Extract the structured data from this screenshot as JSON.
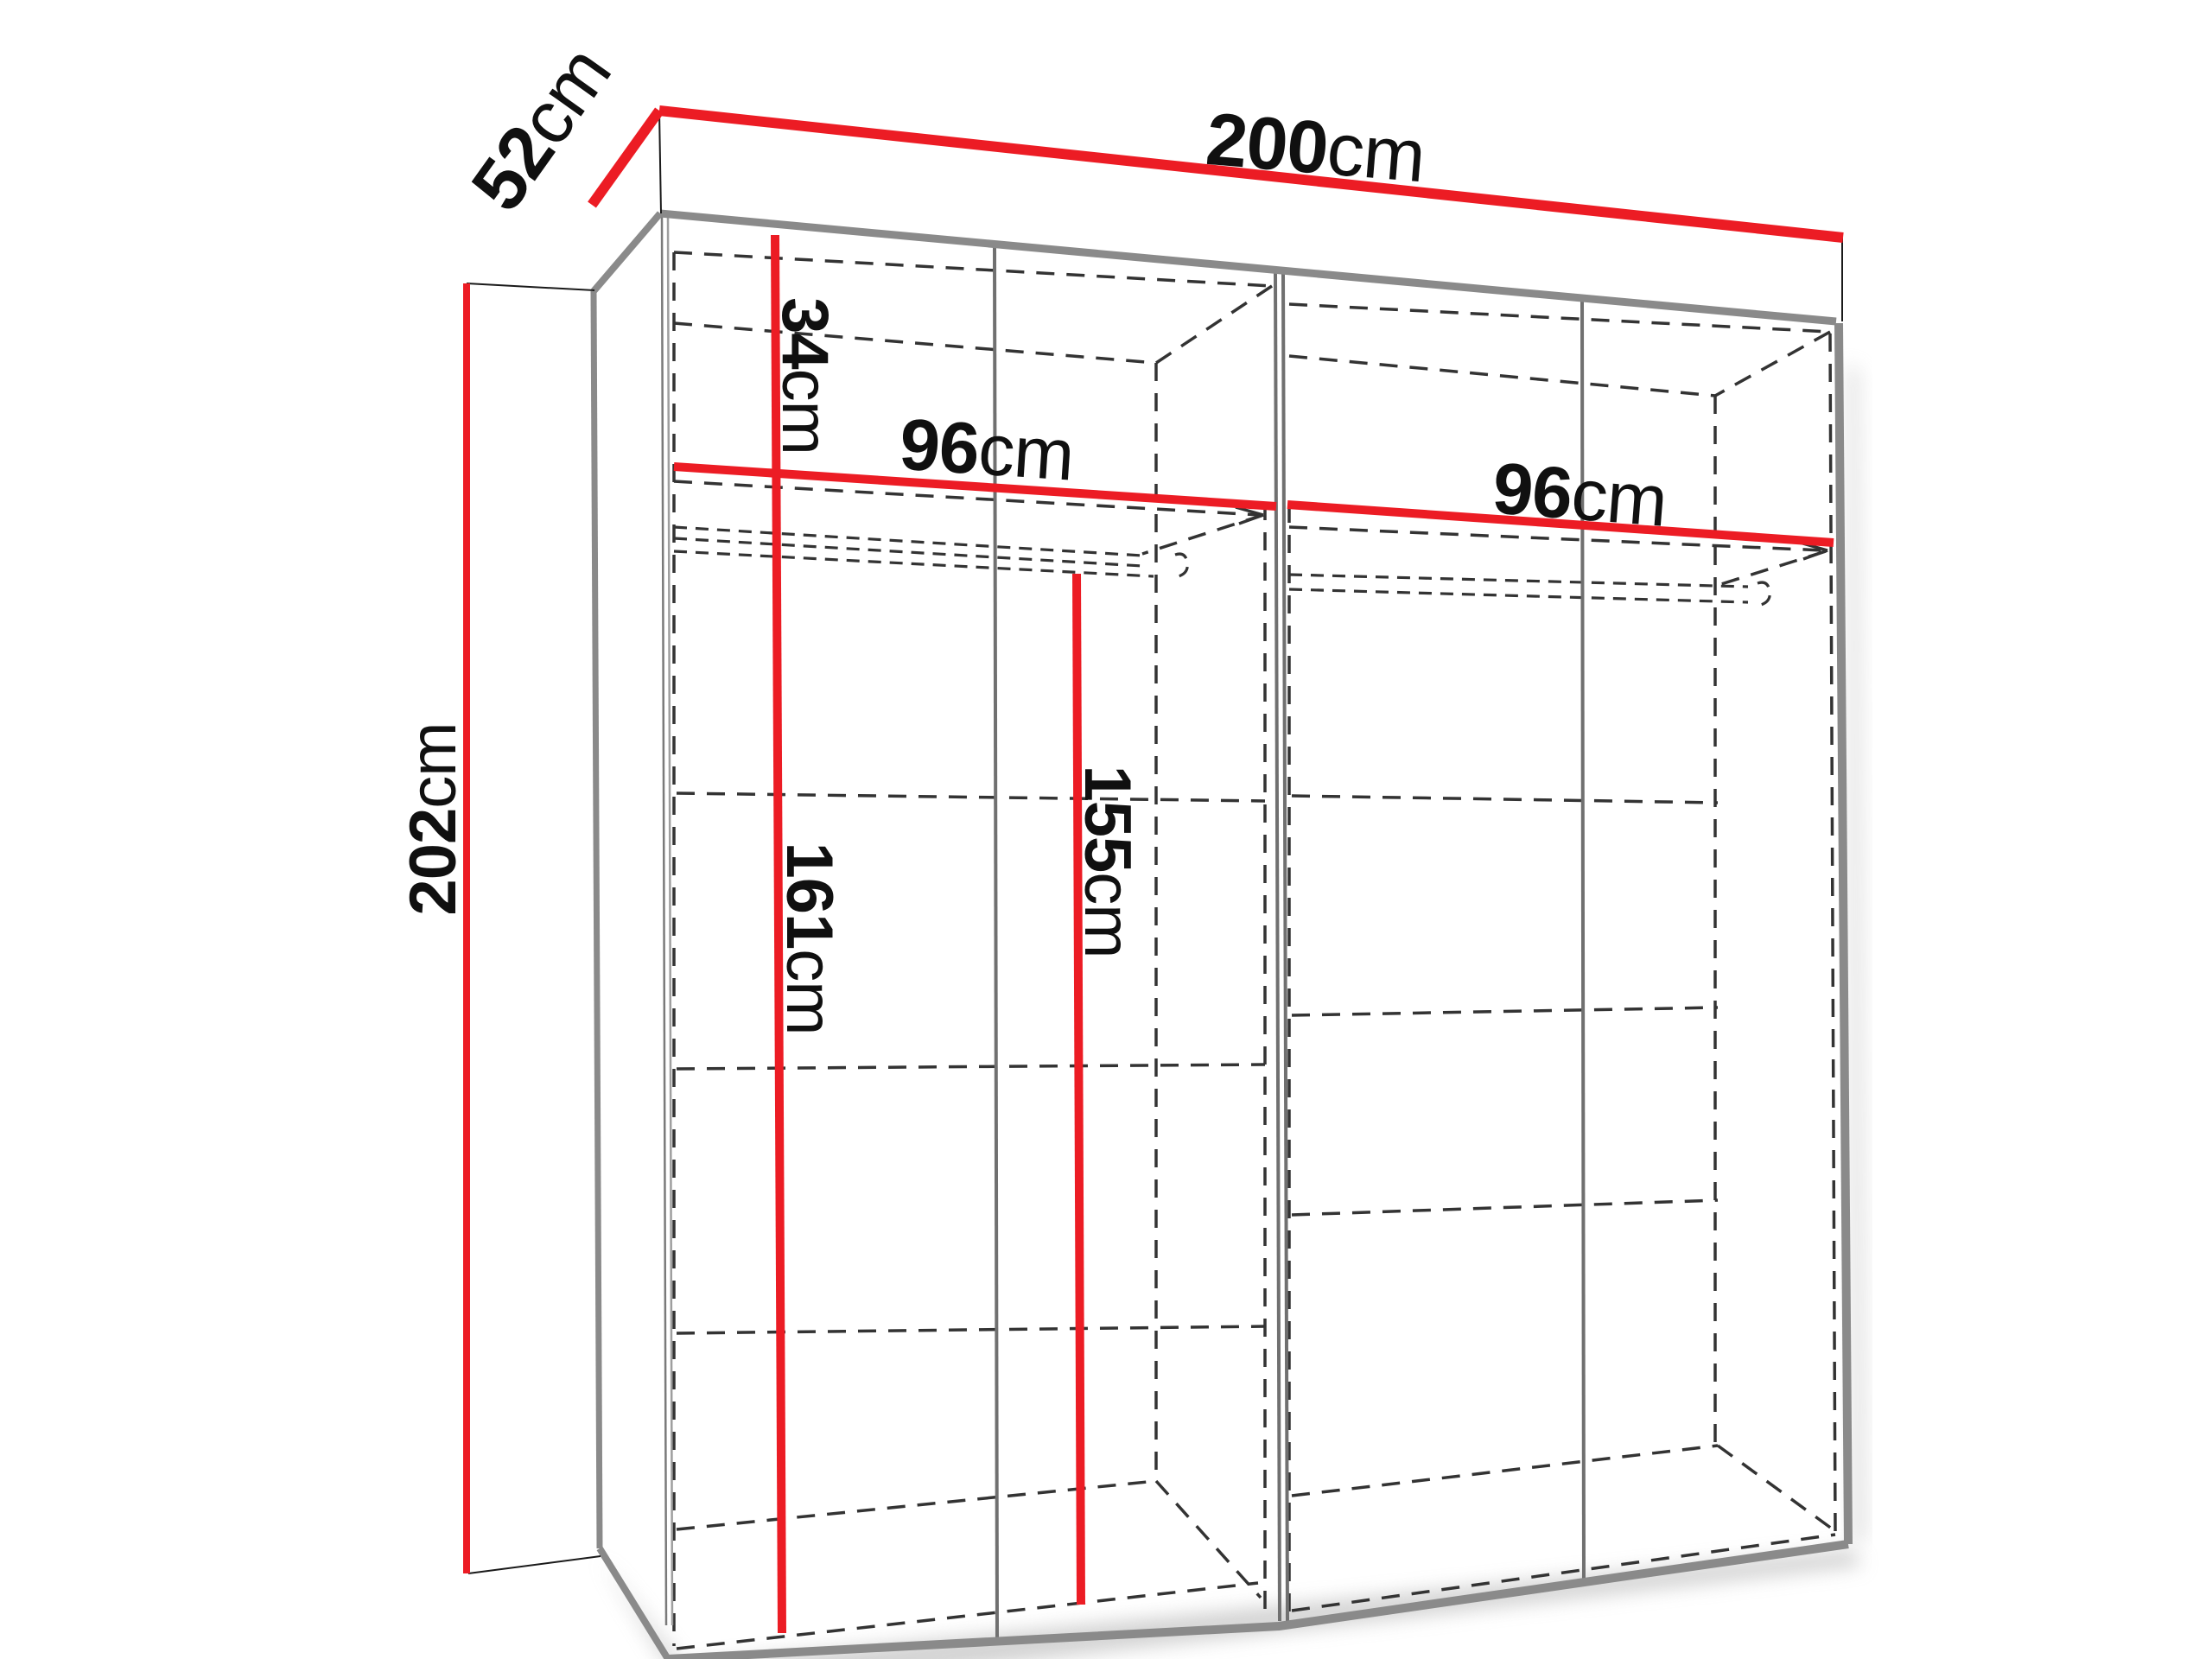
{
  "diagram": {
    "type": "furniture-dimension-diagram",
    "subject": "wardrobe-interior",
    "unit": "cm",
    "labels": {
      "width": {
        "value": "200",
        "unit": "cm"
      },
      "depth": {
        "value": "52",
        "unit": "cm"
      },
      "height": {
        "value": "202",
        "unit": "cm"
      },
      "top_shelf_drop": {
        "value": "34",
        "unit": "cm"
      },
      "left_compartment_width": {
        "value": "96",
        "unit": "cm"
      },
      "right_compartment_width": {
        "value": "96",
        "unit": "cm"
      },
      "left_interior_height": {
        "value": "161",
        "unit": "cm"
      },
      "hanging_rail_height": {
        "value": "155",
        "unit": "cm"
      }
    },
    "colors": {
      "dimension_red": "#ec1c24",
      "edge_gray": "#8a8a8a",
      "divider_gray": "#707070",
      "hidden_line": "#333333",
      "label_text": "#101010",
      "background": "#ffffff"
    }
  }
}
